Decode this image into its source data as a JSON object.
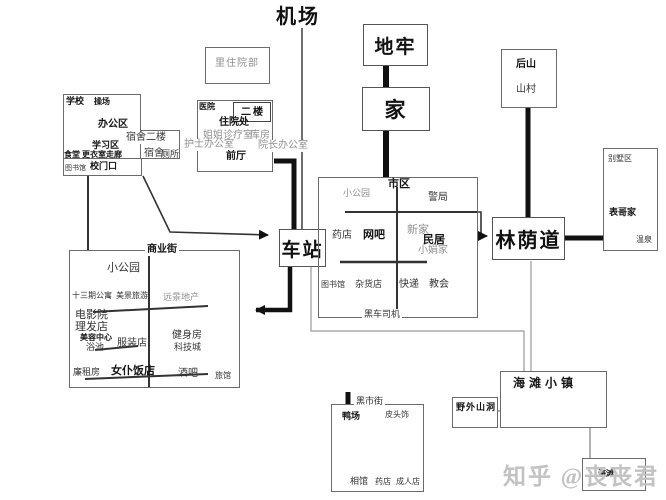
{
  "watermark": {
    "text": "知乎 @丧丧君"
  },
  "nodes": {
    "airport": "机场",
    "dungeon": "地牢",
    "home": "家",
    "back_hill": {
      "top": "后山",
      "bottom": "山村"
    },
    "boulevard": "林荫道",
    "station": "车站",
    "inpatient_ward": "里住院部",
    "beach_town": "海滩小镇",
    "wild_cave": "野外山洞",
    "beach": "海滩"
  },
  "villa": {
    "name": "别墅区",
    "cousin_home": "表哥家",
    "hot_spring": "温泉"
  },
  "hospital": {
    "name": "医院",
    "second_floor": "二楼",
    "admission": "住院处",
    "sister_clinic": "姐姐诊疗室",
    "storeroom": "库房",
    "nurse_office": "护士办公室",
    "director_office": "院长办公室",
    "front_hall": "前厅"
  },
  "school": {
    "name": "学校",
    "playground": "操场",
    "office_area": "办公区",
    "study_area": "学习区",
    "canteen": "食堂",
    "locker_corridor": "更衣室走廊",
    "dorm_2f": "宿舍二楼",
    "dorm": "宿舍",
    "toilet": "厕所",
    "library": "图书馆",
    "gate": "校门口"
  },
  "downtown": {
    "name": "市区",
    "park": "小公园",
    "police": "警局",
    "pharmacy": "药店",
    "net_cafe": "网吧",
    "new_home": "新家",
    "residence": "民居",
    "xiaojuan_home": "小娟家",
    "library": "图书馆",
    "grocery": "杂货店",
    "express": "快递",
    "church": "教会",
    "black_car_driver": "黑车司机"
  },
  "commercial_street": {
    "name": "商业街",
    "park": "小公园",
    "apartment_13": "十三期公寓",
    "travel": "美景旅游",
    "realty": "远景地产",
    "cinema": "电影院",
    "barber": "理发店",
    "beauty_center": "美容中心",
    "bath": "浴池",
    "clothing": "服装店",
    "gym": "健身房",
    "tech_city": "科技城",
    "cheap_rental": "廉租房",
    "maid_restaurant": "女仆饭店",
    "bar": "酒吧",
    "hotel": "旅馆"
  },
  "black_market": {
    "name": "黑市街",
    "duck_farm": "鸭场",
    "headwear": "皮头饰",
    "photo_studio": "相馆",
    "pharmacy": "药店",
    "adult_shop": "成人店"
  }
}
